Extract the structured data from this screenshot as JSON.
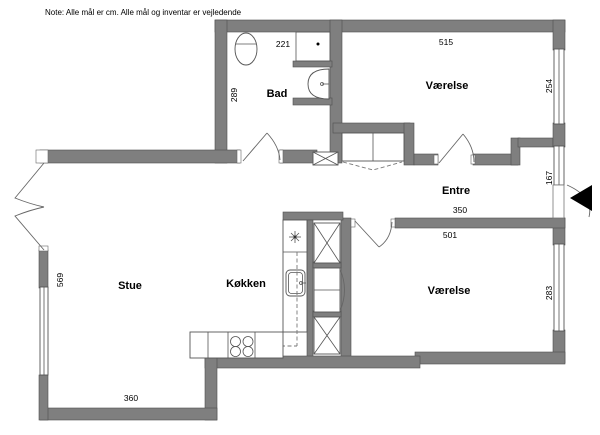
{
  "note": "Note: Alle mål er cm. Alle mål og inventar er vejledende",
  "rooms": {
    "bad": "Bad",
    "vaerelse_top": "Værelse",
    "entre": "Entre",
    "stue": "Stue",
    "koekken": "Køkken",
    "vaerelse_bottom": "Værelse"
  },
  "dimensions": {
    "bad_width_cm": "221",
    "bad_depth_cm": "289",
    "vaerelse_top_width_cm": "515",
    "vaerelse_top_window_cm": "254",
    "entre_window_cm": "167",
    "entre_width_cm": "350",
    "vaerelse_bottom_width_cm": "501",
    "vaerelse_bottom_window_cm": "283",
    "stue_depth_cm": "569",
    "stue_width_cm": "360"
  },
  "colors": {
    "wall": "#7f7f7f",
    "wall_outline": "#4f4f4f",
    "line": "#555555",
    "text": "#000000",
    "background": "#ffffff",
    "entrance_marker": "#000000"
  }
}
